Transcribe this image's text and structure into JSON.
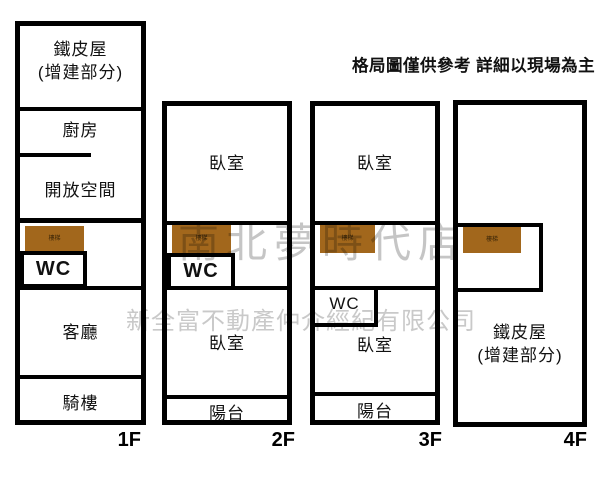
{
  "disclaimer": "格局圖僅供參考 詳細以現場為主",
  "watermarks": {
    "store": "南北夢時代店",
    "company": "新全富不動產仲介經紀有限公司"
  },
  "stairs_label": "樓梯",
  "colors": {
    "stairs_brown": "#a2671c",
    "wall_black": "#000000",
    "watermark_gray": "#c9c9c9"
  },
  "floors": {
    "f1": {
      "label": "1F",
      "rooms": {
        "tin_line1": "鐵皮屋",
        "tin_line2": "(增建部分)",
        "kitchen": "廚房",
        "open_space": "開放空間",
        "wc": "WC",
        "living": "客廳",
        "arcade": "騎樓"
      }
    },
    "f2": {
      "label": "2F",
      "rooms": {
        "bedroom_top": "臥室",
        "wc": "WC",
        "bedroom_bottom": "臥室",
        "balcony": "陽台"
      }
    },
    "f3": {
      "label": "3F",
      "rooms": {
        "bedroom_top": "臥室",
        "wc": "WC",
        "bedroom_bottom": "臥室",
        "balcony": "陽台"
      }
    },
    "f4": {
      "label": "4F",
      "rooms": {
        "tin_line1": "鐵皮屋",
        "tin_line2": "(增建部分)"
      }
    }
  }
}
